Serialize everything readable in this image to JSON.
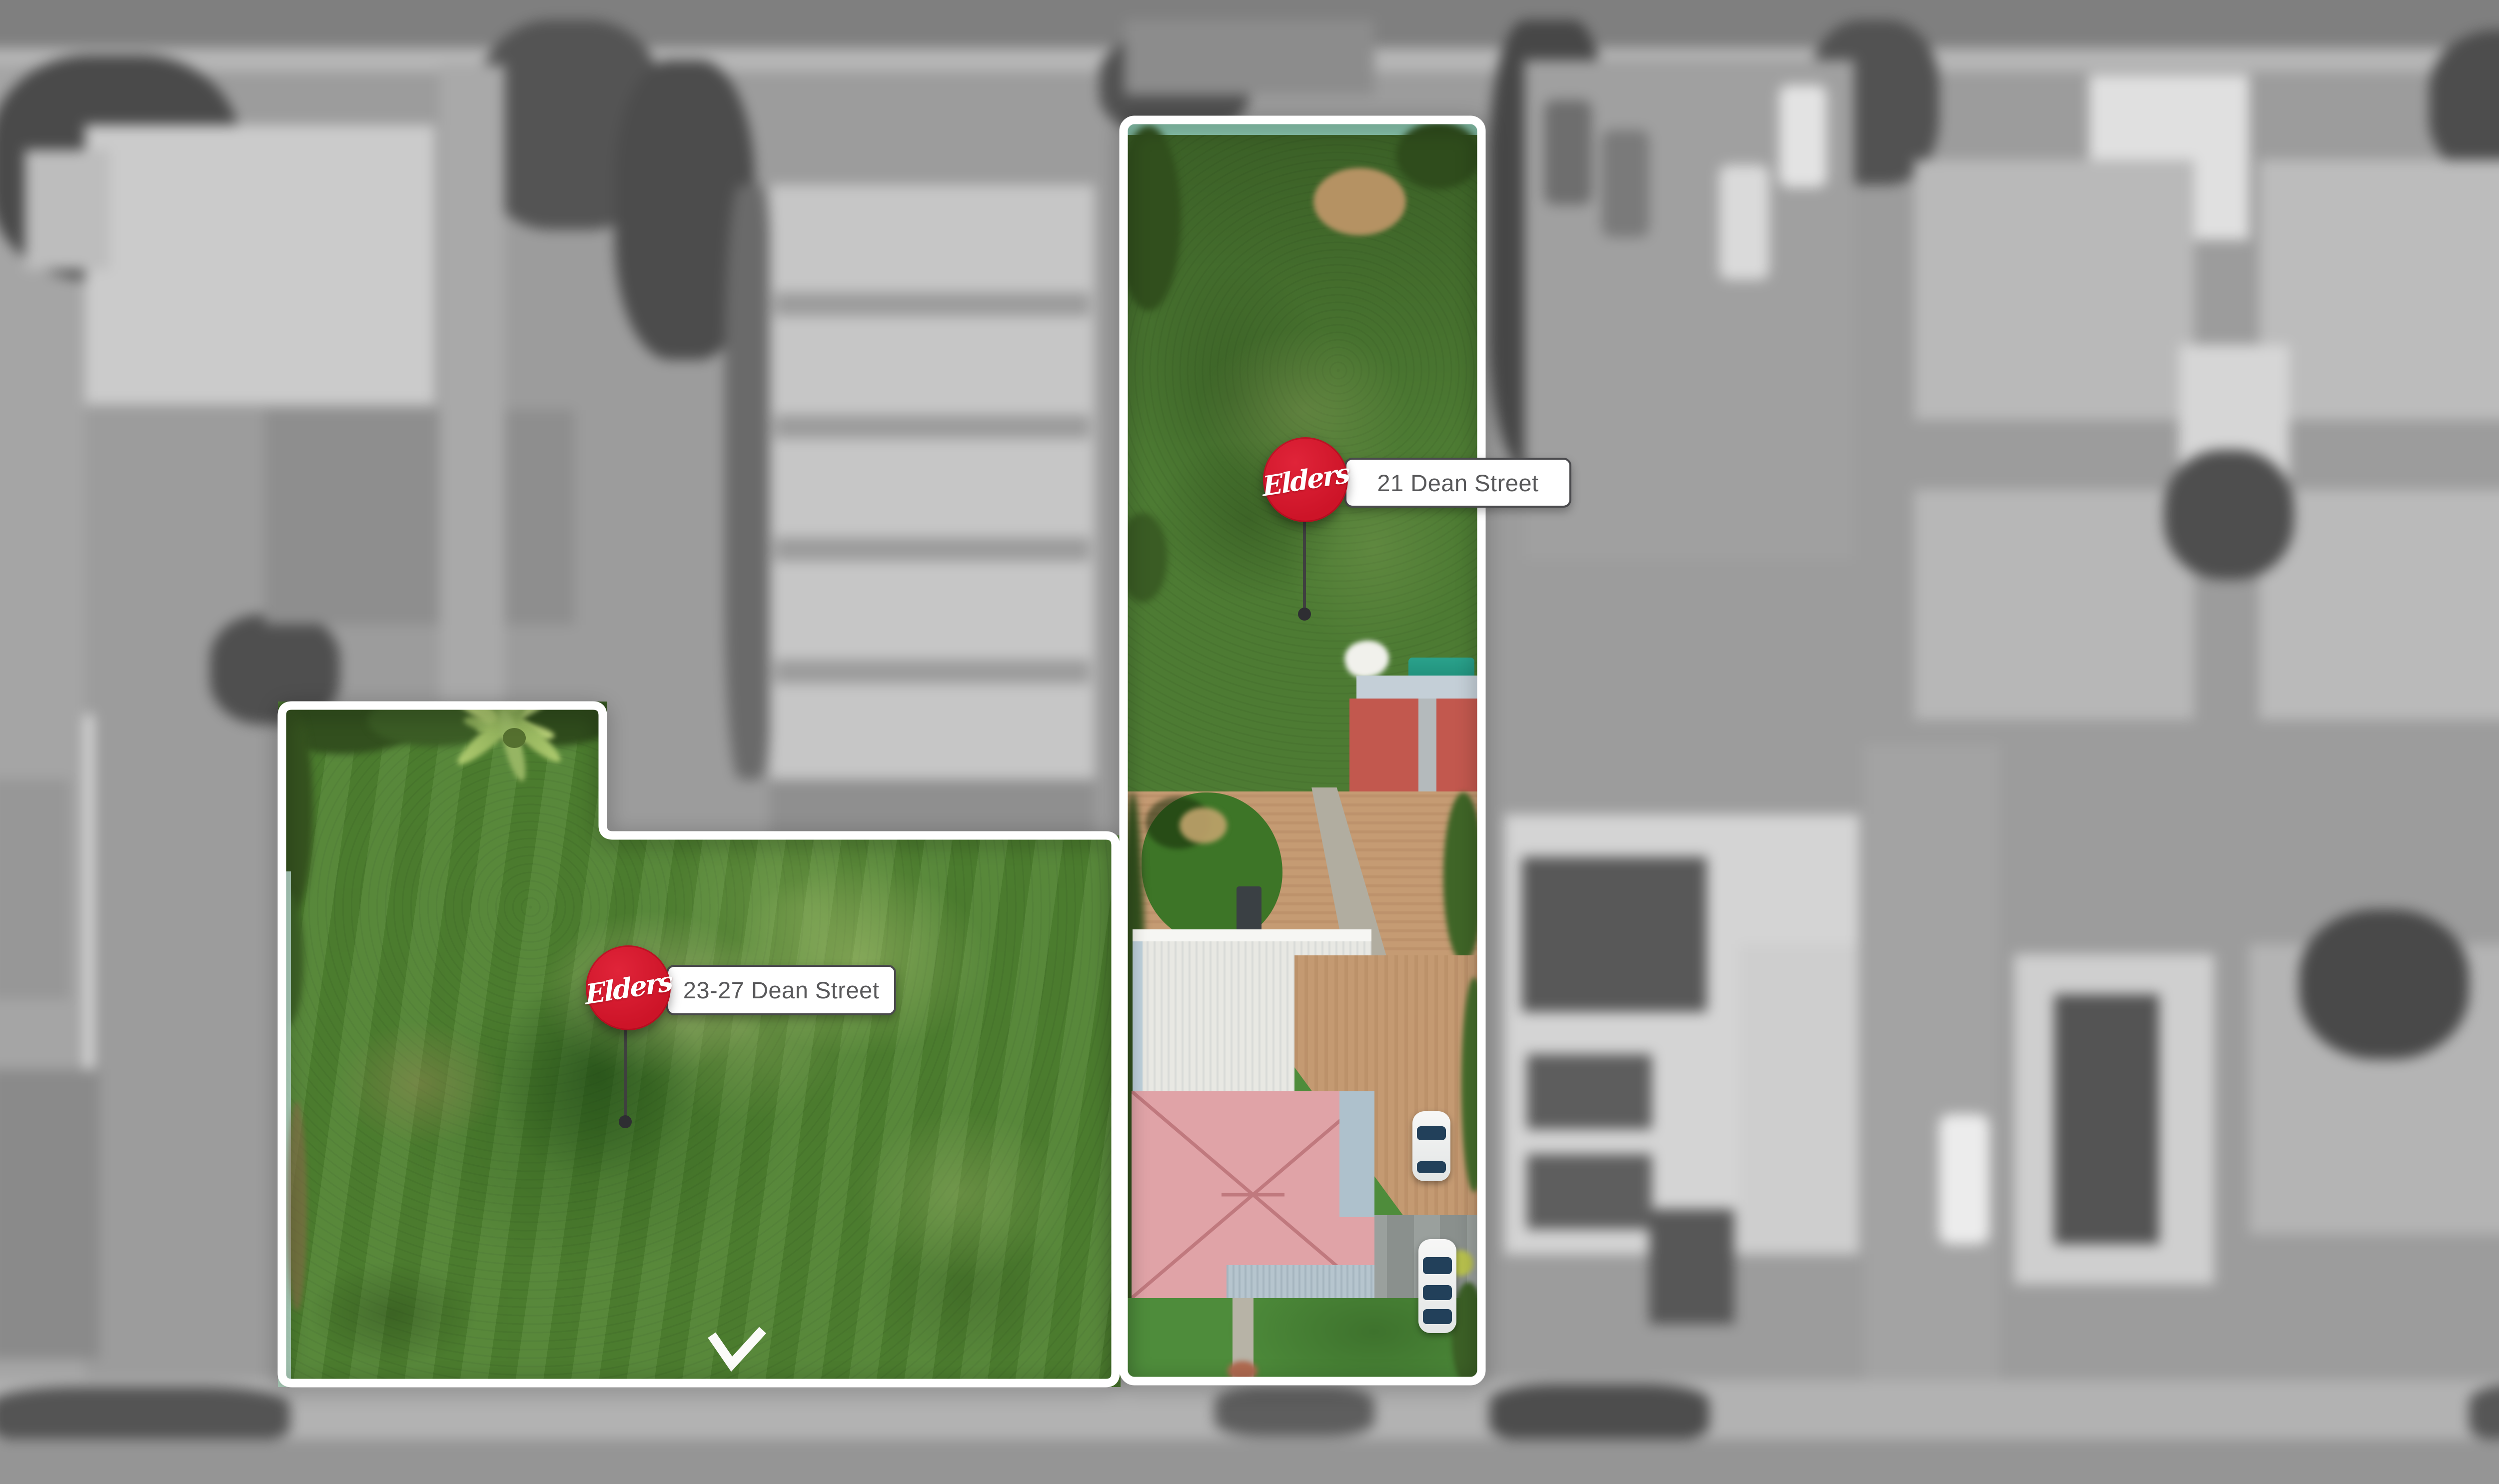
{
  "markers": [
    {
      "id": "21-dean-street",
      "logo": "Elders",
      "label": "21 Dean Street"
    },
    {
      "id": "23-27-dean-street",
      "logo": "Elders",
      "label": "23-27 Dean Street"
    }
  ],
  "colors": {
    "elders_red": "#CD1428",
    "elders_red_light": "#E02439",
    "label_text": "#58585A",
    "label_border": "#4A4A4D",
    "boundary_white": "#FFFFFF",
    "stem_gray": "#3F3F3F"
  }
}
